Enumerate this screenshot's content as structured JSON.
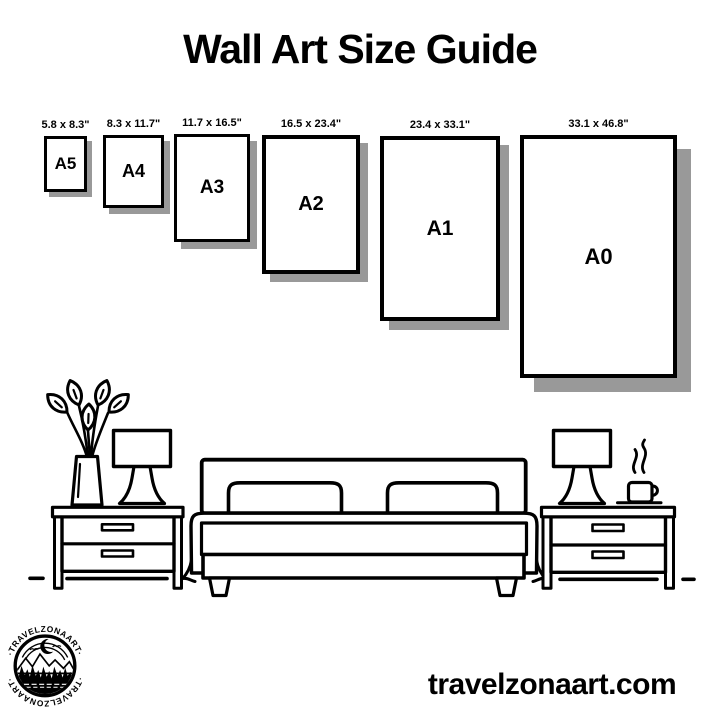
{
  "title": "Wall Art Size Guide",
  "sizes": [
    {
      "name": "A5",
      "dims": "5.8 x 8.3\""
    },
    {
      "name": "A4",
      "dims": "8.3 x 11.7\""
    },
    {
      "name": "A3",
      "dims": "11.7 x 16.5\""
    },
    {
      "name": "A2",
      "dims": "16.5 x 23.4\""
    },
    {
      "name": "A1",
      "dims": "23.4 x 33.1\""
    },
    {
      "name": "A0",
      "dims": "33.1 x 46.8\""
    }
  ],
  "website": "travelzonaart.com",
  "logo": {
    "text_top": "·TRAVELZONAART·",
    "text_bottom": "·TRAVELZONAART·"
  },
  "colors": {
    "ink": "#000000",
    "shadow": "#999999",
    "bg": "#ffffff"
  }
}
